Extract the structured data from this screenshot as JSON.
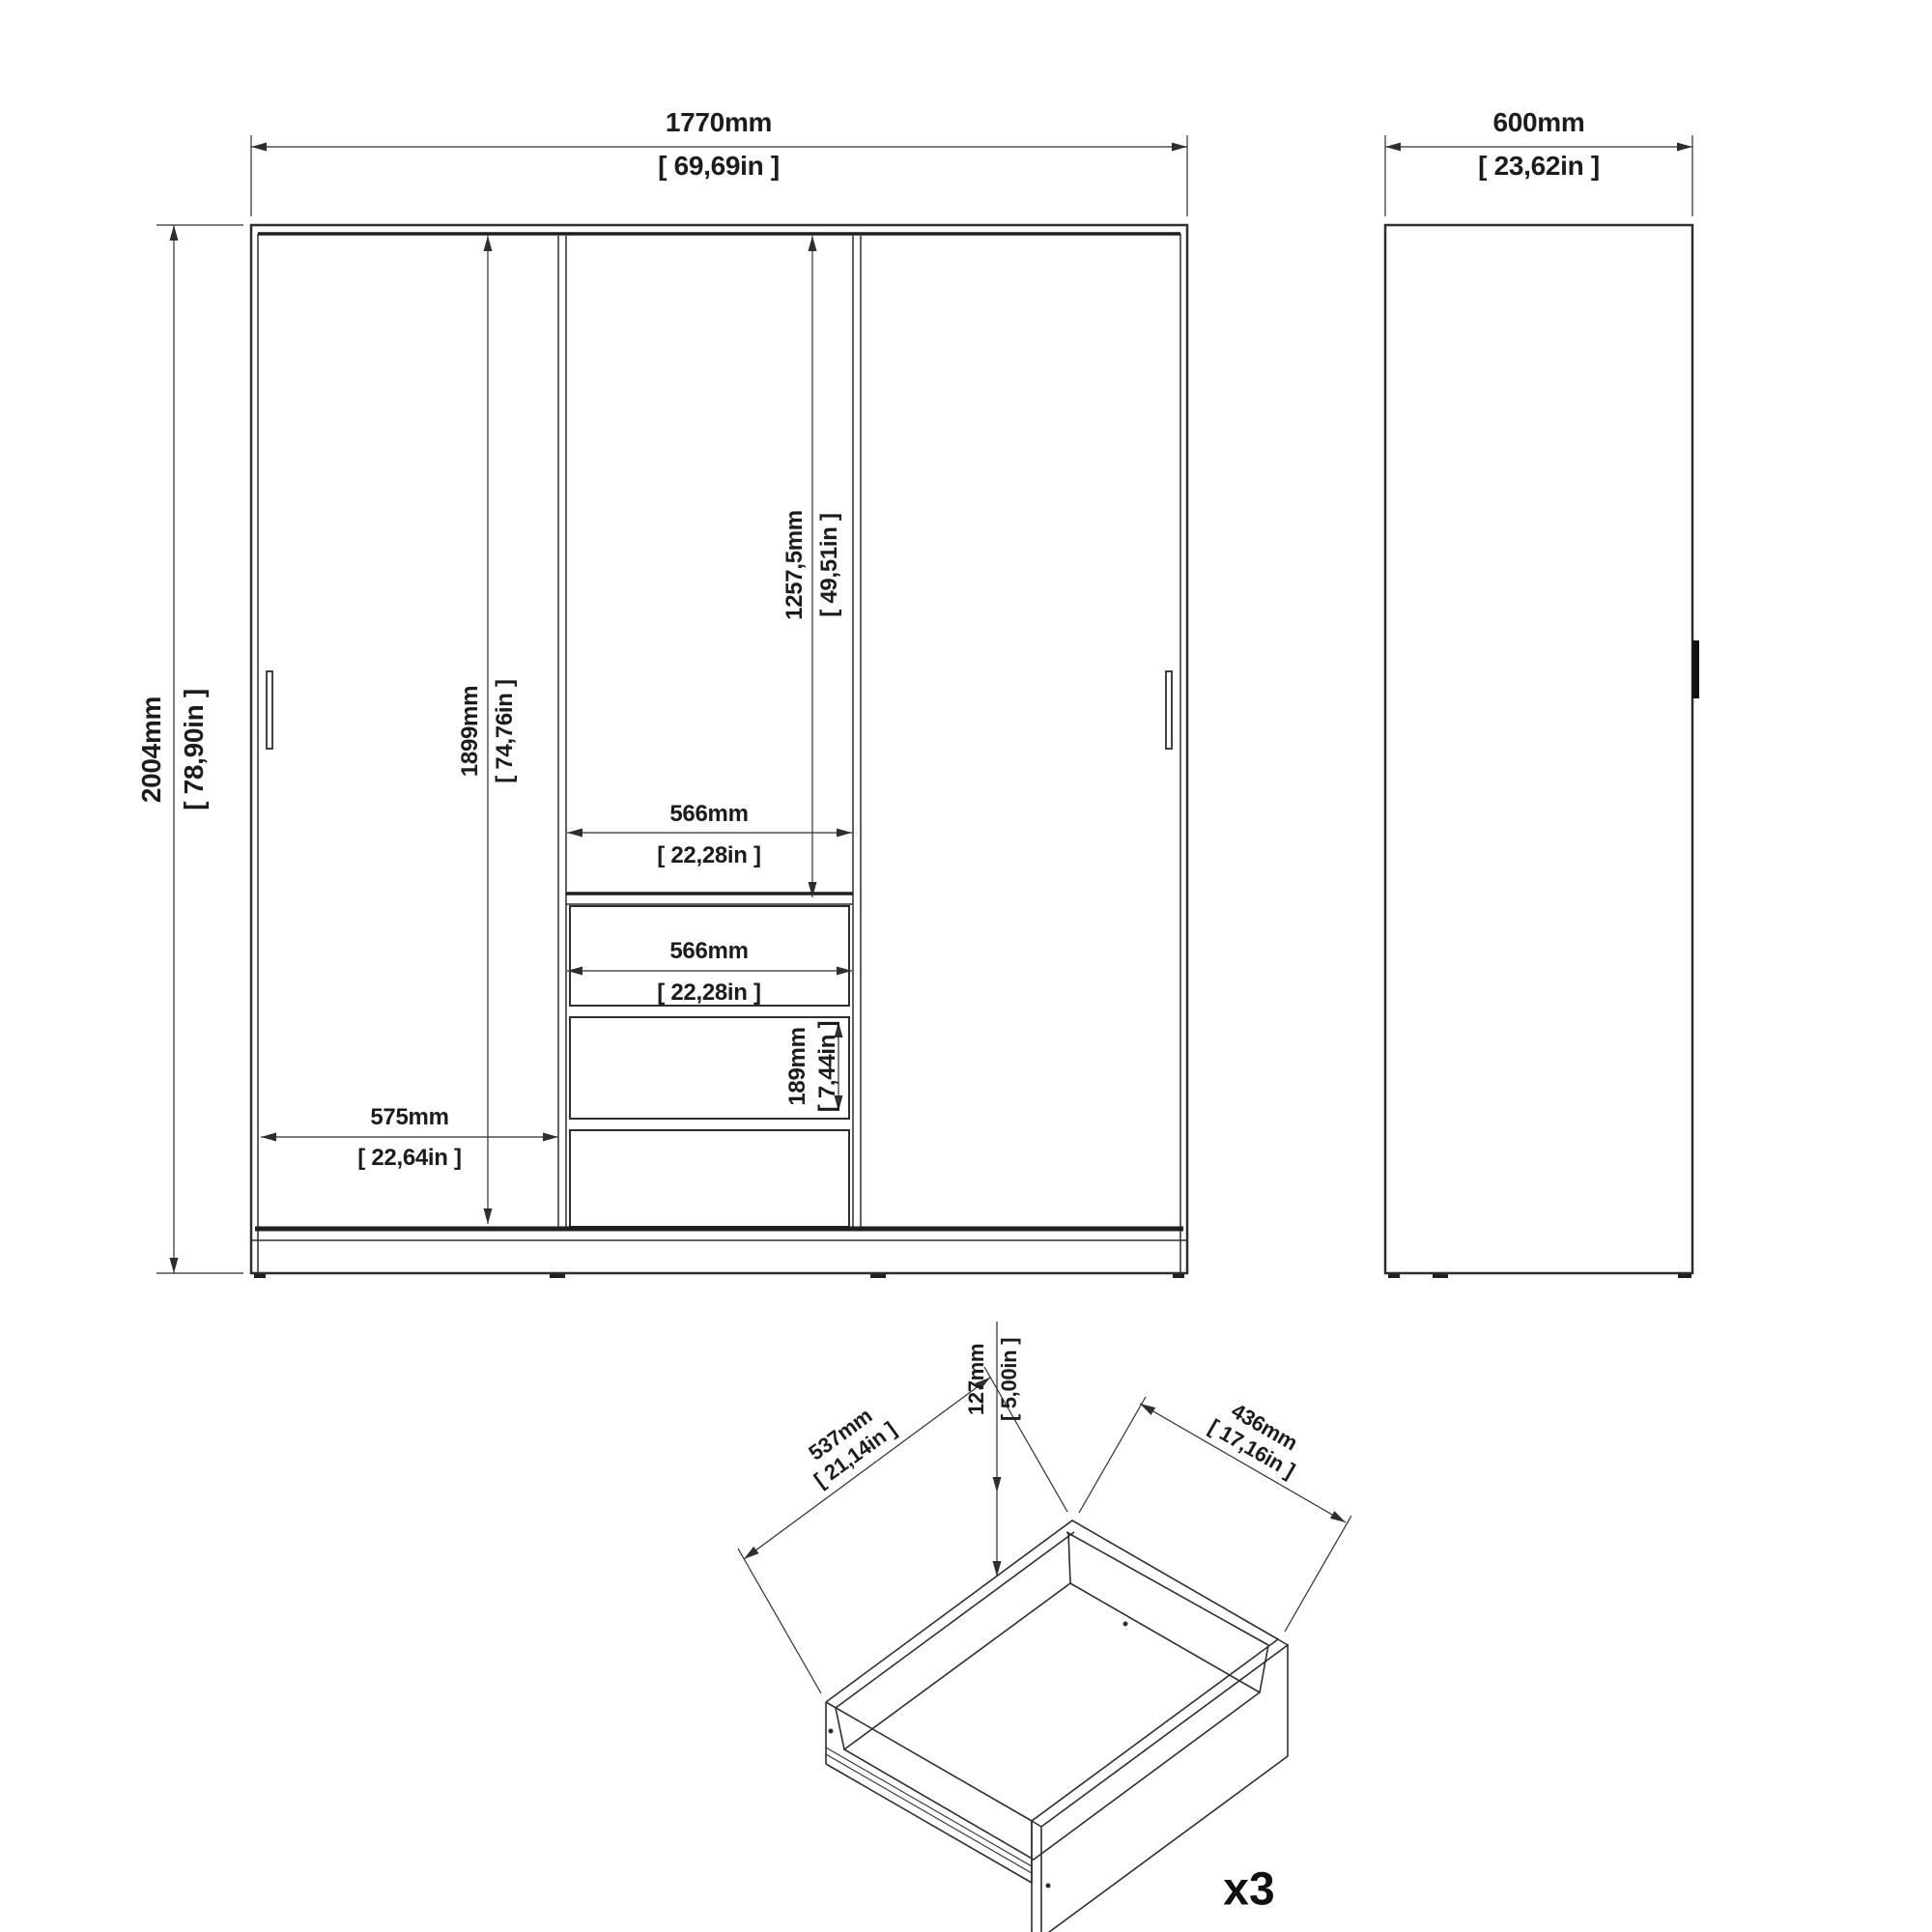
{
  "drawing": {
    "type": "wardrobe technical drawing",
    "colors": {
      "line": "#2e2e2e",
      "thick_line": "#1f1f1f",
      "text": "#1c1c1c",
      "background": "#ffffff",
      "handle_fill": "#111111"
    },
    "front_view": {
      "width": {
        "mm": "1770mm",
        "inch": "[ 69,69in ]"
      },
      "height": {
        "mm": "2004mm",
        "inch": "[ 78,90in ]"
      },
      "door_height": {
        "mm": "1899mm",
        "inch": "[ 74,76in ]"
      },
      "upper_section_height": {
        "mm": "1257,5mm",
        "inch": "[ 49,51in ]"
      },
      "shelf_width_top": {
        "mm": "566mm",
        "inch": "[ 22,28in ]"
      },
      "shelf_width_mid": {
        "mm": "566mm",
        "inch": "[ 22,28in ]"
      },
      "drawer_front_height": {
        "mm": "189mm",
        "inch": "[ 7,44in ]"
      },
      "door_width": {
        "mm": "575mm",
        "inch": "[ 22,64in ]"
      }
    },
    "side_view": {
      "depth": {
        "mm": "600mm",
        "inch": "[ 23,62in ]"
      }
    },
    "drawer_detail": {
      "height": {
        "mm": "127mm",
        "inch": "[ 5,00in ]"
      },
      "width": {
        "mm": "537mm",
        "inch": "[ 21,14in ]"
      },
      "depth": {
        "mm": "436mm",
        "inch": "[ 17,16in ]"
      },
      "quantity_label": "x3"
    }
  }
}
